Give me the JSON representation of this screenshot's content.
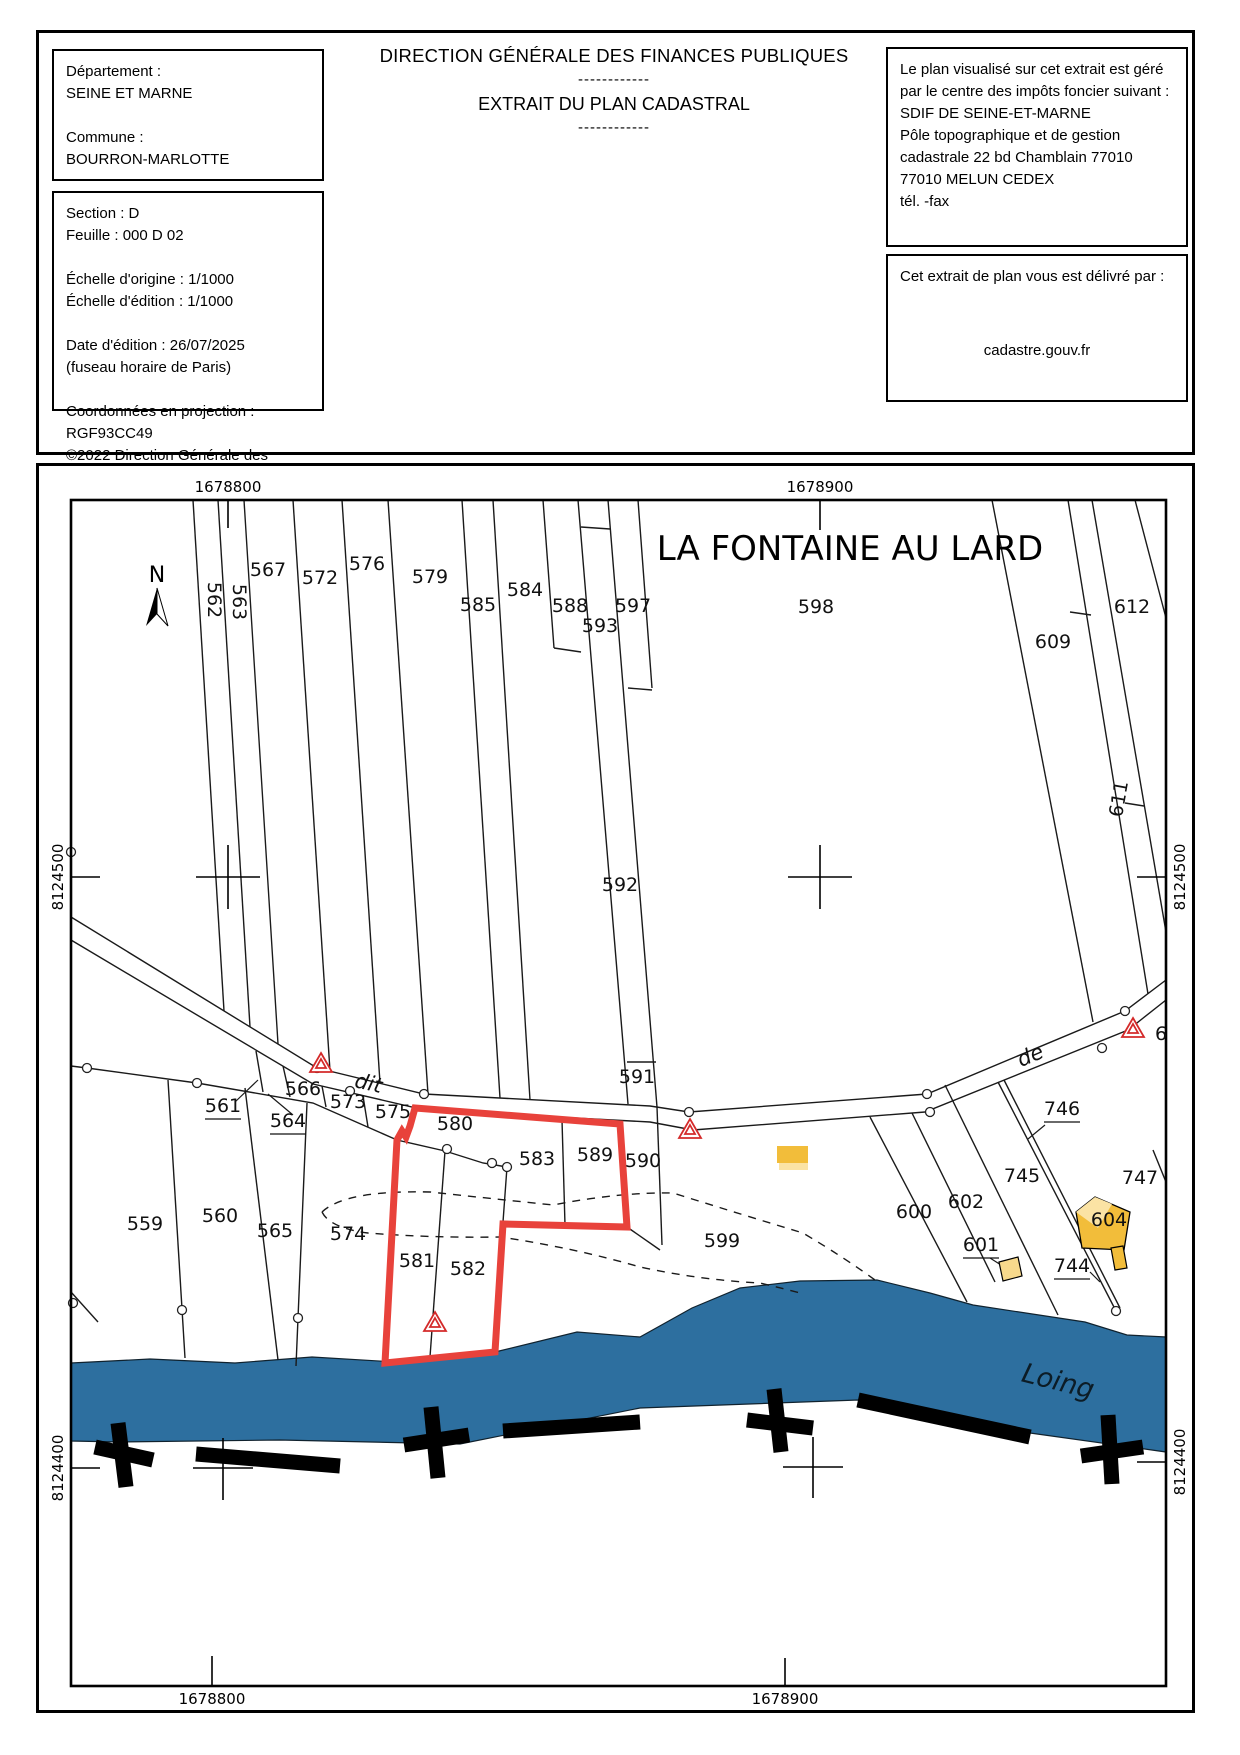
{
  "header": {
    "org_title": "DIRECTION GÉNÉRALE DES FINANCES PUBLIQUES",
    "divider": "------------",
    "doc_title": "EXTRAIT DU PLAN CADASTRAL",
    "left_box": {
      "dept_label": "Département :",
      "dept_value": "SEINE ET MARNE",
      "commune_label": "Commune :",
      "commune_value": "BOURRON-MARLOTTE"
    },
    "info_box": {
      "section": "Section : D",
      "feuille": "Feuille : 000 D 02",
      "scale_orig": "Échelle d'origine : 1/1000",
      "scale_ed": "Échelle d'édition : 1/1000",
      "date": "Date d'édition : 26/07/2025",
      "tz": "(fuseau horaire de Paris)",
      "proj": "Coordonnées en projection : RGF93CC49",
      "copyright1": "©2022 Direction Générale des Finances",
      "copyright2": "Publiques"
    },
    "manager_box": {
      "lines": [
        "Le plan visualisé sur cet extrait est géré",
        "par le centre des impôts foncier suivant :",
        "SDIF DE SEINE-ET-MARNE",
        "Pôle topographique et de gestion",
        "cadastrale 22 bd Chamblain 77010",
        "77010 MELUN CEDEX",
        "tél.  -fax"
      ]
    },
    "delivery_box": {
      "intro": "Cet extrait de plan vous est délivré par :",
      "provider": "cadastre.gouv.fr"
    }
  },
  "map": {
    "place_name": "LA FONTAINE AU LARD",
    "north_label": "N",
    "river_label": "Loing",
    "road_labels": [
      {
        "t": "dit",
        "x": 367,
        "y": 1090,
        "r": 13
      },
      {
        "t": "de",
        "x": 1033,
        "y": 1062,
        "r": -23
      }
    ],
    "coordinates": {
      "x": [
        "1678800",
        "1678900"
      ],
      "y": [
        "8124500",
        "8124400"
      ]
    },
    "parcels": [
      {
        "t": "562",
        "x": 208,
        "y": 600,
        "r": 90
      },
      {
        "t": "563",
        "x": 233,
        "y": 602,
        "r": 90
      },
      {
        "t": "567",
        "x": 268,
        "y": 576
      },
      {
        "t": "572",
        "x": 320,
        "y": 584
      },
      {
        "t": "576",
        "x": 367,
        "y": 570
      },
      {
        "t": "579",
        "x": 430,
        "y": 583
      },
      {
        "t": "585",
        "x": 478,
        "y": 611
      },
      {
        "t": "584",
        "x": 525,
        "y": 596
      },
      {
        "t": "588",
        "x": 570,
        "y": 612
      },
      {
        "t": "593",
        "x": 600,
        "y": 632
      },
      {
        "t": "597",
        "x": 633,
        "y": 612
      },
      {
        "t": "598",
        "x": 816,
        "y": 613
      },
      {
        "t": "609",
        "x": 1053,
        "y": 648
      },
      {
        "t": "612",
        "x": 1132,
        "y": 613
      },
      {
        "t": "611",
        "x": 1125,
        "y": 800,
        "r": -80
      },
      {
        "t": "6",
        "x": 1161,
        "y": 1040
      },
      {
        "t": "592",
        "x": 620,
        "y": 891
      },
      {
        "t": "591",
        "x": 637,
        "y": 1083
      },
      {
        "t": "566",
        "x": 303,
        "y": 1095
      },
      {
        "t": "573",
        "x": 348,
        "y": 1108
      },
      {
        "t": "575",
        "x": 393,
        "y": 1118
      },
      {
        "t": "561",
        "x": 223,
        "y": 1112,
        "u": 1
      },
      {
        "t": "564",
        "x": 288,
        "y": 1127,
        "u": 1
      },
      {
        "t": "580",
        "x": 455,
        "y": 1130
      },
      {
        "t": "583",
        "x": 537,
        "y": 1165
      },
      {
        "t": "589",
        "x": 595,
        "y": 1161
      },
      {
        "t": "590",
        "x": 643,
        "y": 1167
      },
      {
        "t": "559",
        "x": 145,
        "y": 1230
      },
      {
        "t": "560",
        "x": 220,
        "y": 1222
      },
      {
        "t": "565",
        "x": 275,
        "y": 1237
      },
      {
        "t": "574",
        "x": 348,
        "y": 1240
      },
      {
        "t": "581",
        "x": 417,
        "y": 1267
      },
      {
        "t": "582",
        "x": 468,
        "y": 1275
      },
      {
        "t": "599",
        "x": 722,
        "y": 1247
      },
      {
        "t": "600",
        "x": 914,
        "y": 1218
      },
      {
        "t": "602",
        "x": 966,
        "y": 1208
      },
      {
        "t": "601",
        "x": 981,
        "y": 1251,
        "u": 1
      },
      {
        "t": "745",
        "x": 1022,
        "y": 1182
      },
      {
        "t": "746",
        "x": 1062,
        "y": 1115,
        "u": 1
      },
      {
        "t": "747",
        "x": 1140,
        "y": 1184
      },
      {
        "t": "744",
        "x": 1072,
        "y": 1272,
        "u": 1
      },
      {
        "t": "604",
        "x": 1109,
        "y": 1226
      }
    ],
    "colors": {
      "river": "#2d6f9f",
      "highlight": "#e8423b",
      "symbol_red": "#d42a2a",
      "building_dark": "#f2bd3a",
      "building_light": "#fbe3a4"
    }
  }
}
